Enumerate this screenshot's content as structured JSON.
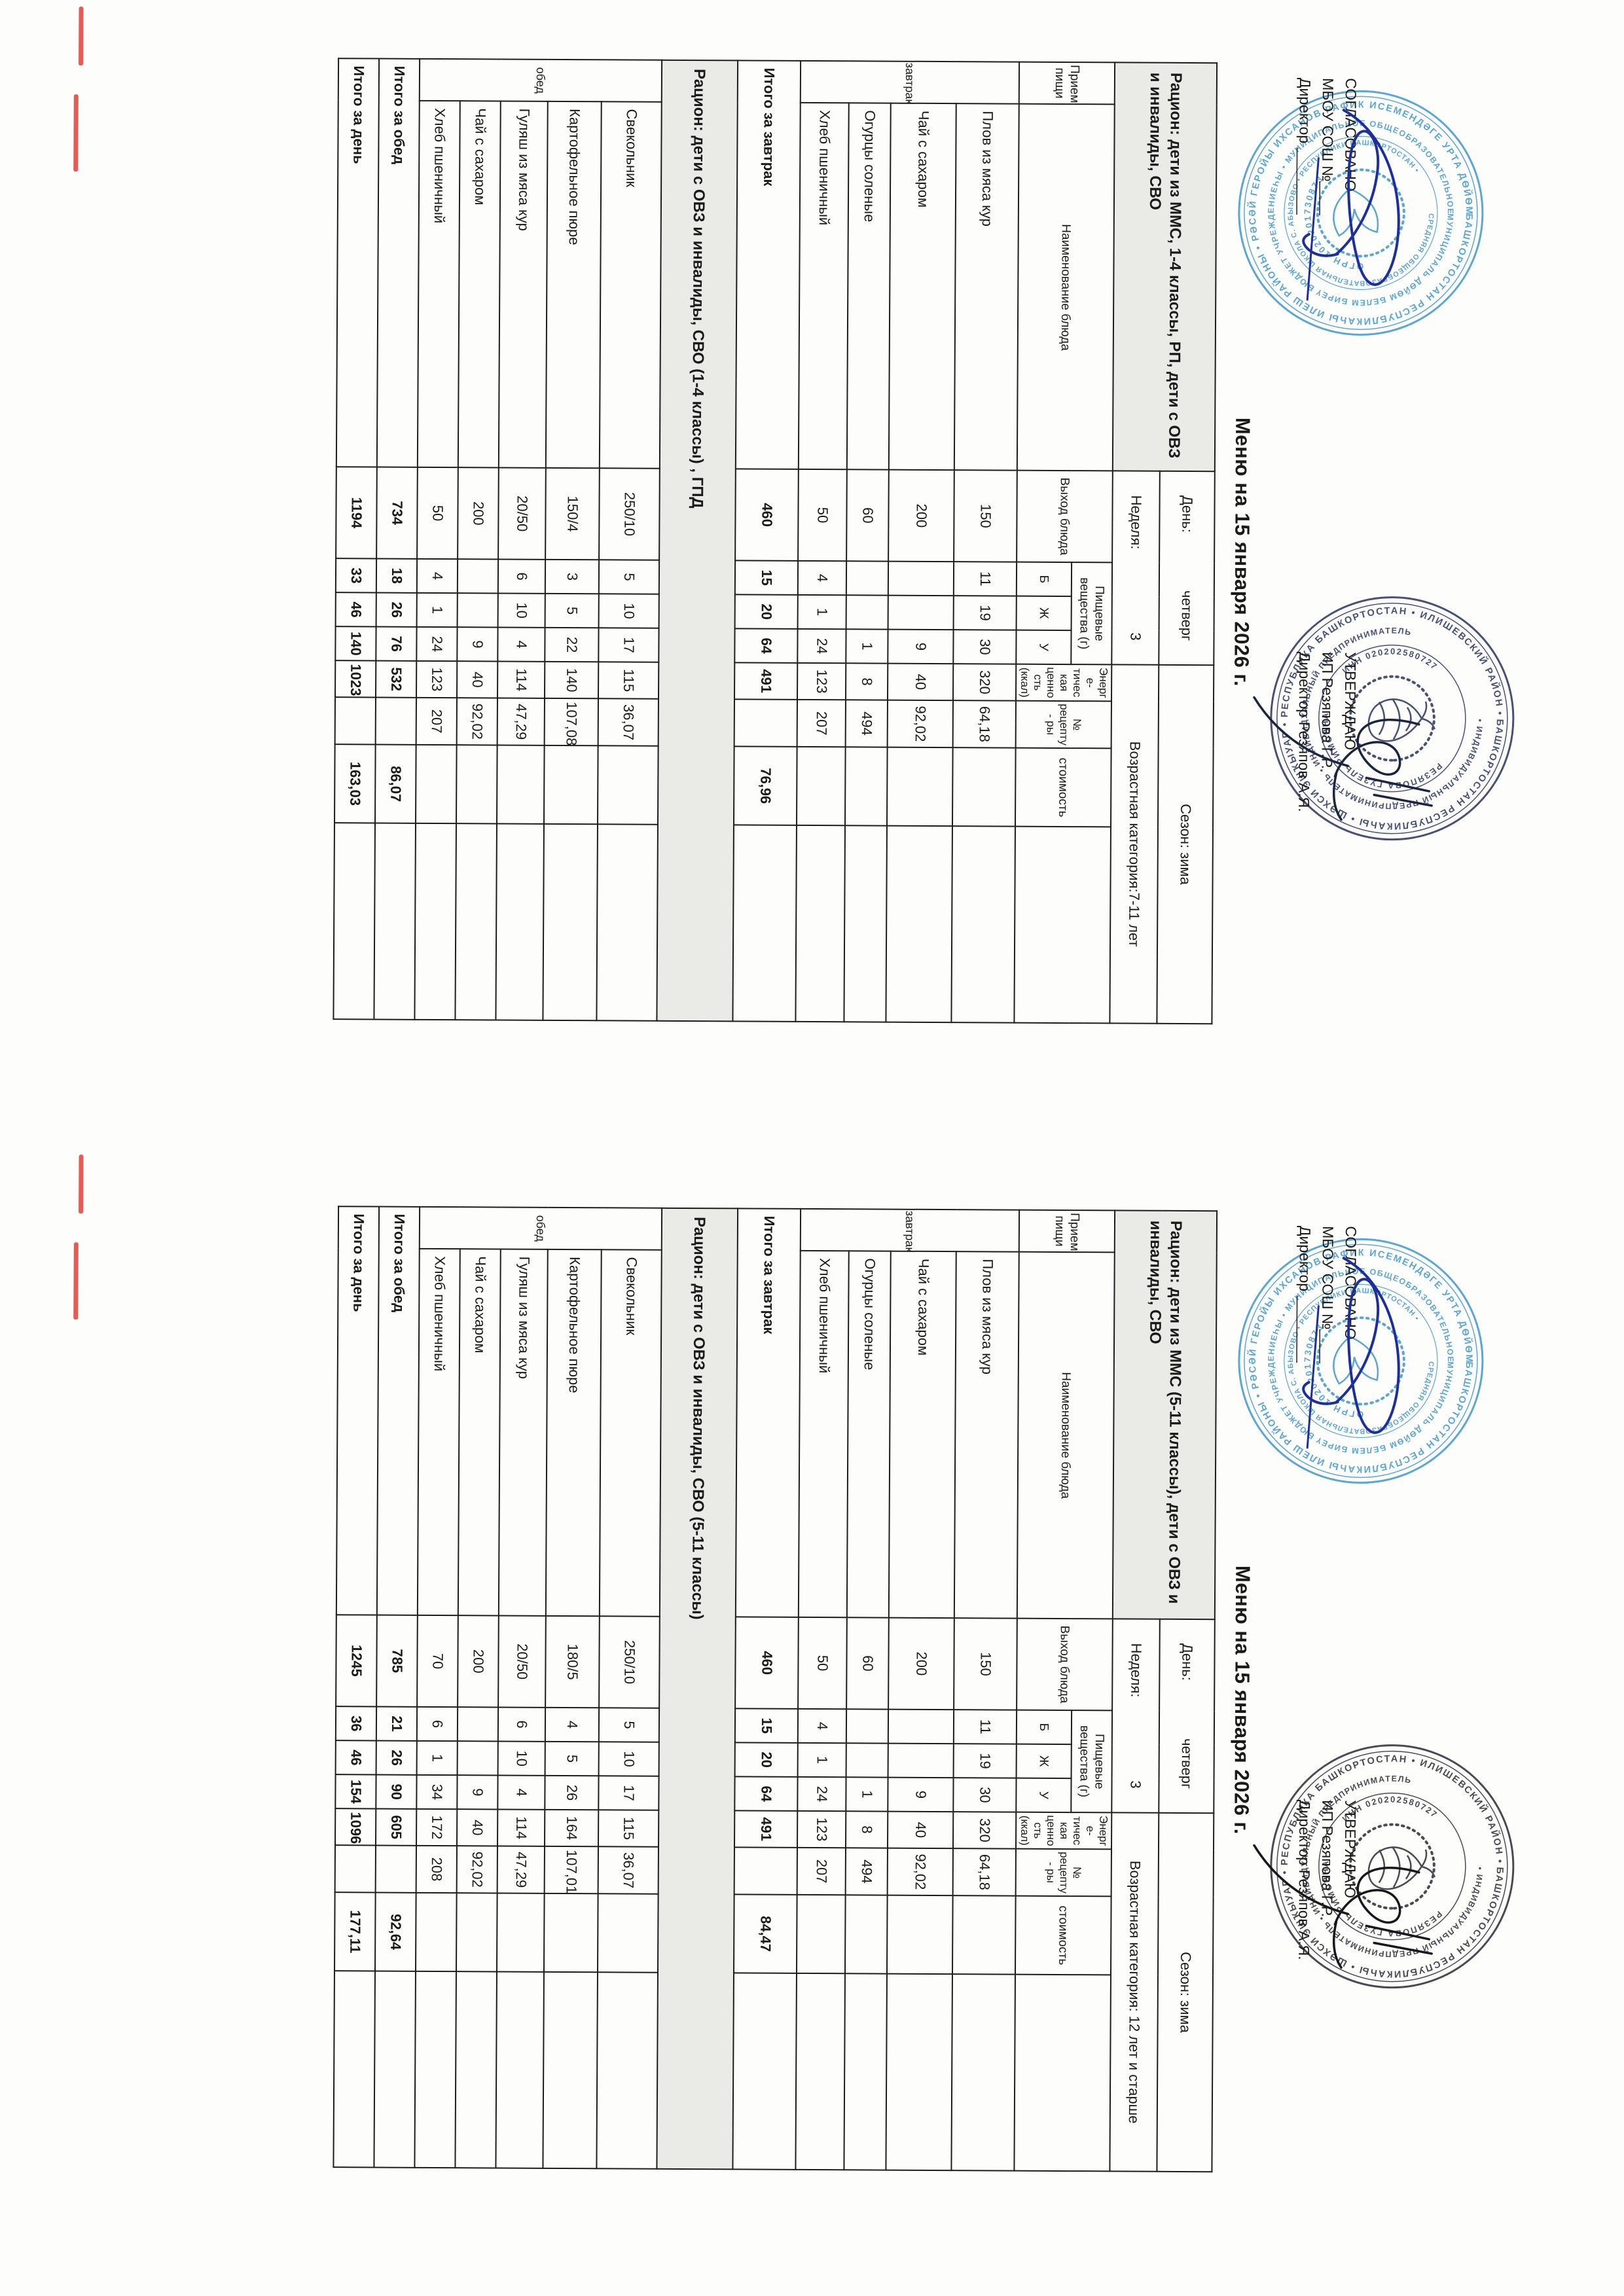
{
  "document": {
    "menu_title": "Меню на 15 января 2026 г.",
    "agreed_block": {
      "line1": "СОГЛАСОВАНО",
      "line2": "МБОУ СОШ №____",
      "line3": "Директор ________"
    },
    "approved_block": {
      "line1": "УТВЕРЖДАЮ",
      "line2": "ИП Резяпова Г.Р.",
      "line3": "Директор Резяпов А.Я."
    }
  },
  "stamps": {
    "school": {
      "color": "#4e9fd2",
      "ring_outer": "БАШКОРТОСТАН РЕСПУБЛИКАҺЫ ИЛЕШ РАЙОНЫ • РӘСӘЙ ГЕРОЙЫ ИХСАНОВ РАФИК ИСЕМЕНДӘГЕ УРТА ДѲЙѲМ БЕЛЕМ БИРЕҮ •",
      "ring_mid": "МУНИЦИПАЛЬ ДѲЙѲМ БЕЛЕМ БИРЕҮ БЮДЖЕТ УЧРЕЖДЕНИЕҺЫ • МУНИЦИПАЛЬНОЕ ОБЩЕОБРАЗОВАТЕЛЬНОЕ БЮДЖЕТНОЕ УЧРЕЖДЕНИЕ",
      "ring_inner": "СРЕДНЯЯ ОБЩЕОБРАЗОВАТЕЛЬНАЯ ШКОЛА С. АБЫЗОВО • РЕСПУБЛИКИ БАШКОРТОСТАН •",
      "ogrn": "ОГРН 1020201730873"
    },
    "ip": {
      "color": "#39426b",
      "color_second": "#3b3b44",
      "ring_outer": "БАШКОРТОСТАН РЕСПУБЛИКАҺЫ • ШӘХСИ ЭШҠЫУАР • РЕСПУБЛИКА БАШКОРТОСТАН • ИЛИШЕВСКИЙ РАЙОН •",
      "ring_mid": "• ИНДИВИДУАЛЬНЫЙ ПРЕДПРИНИМАТЕЛЬ • ИНДИВИДУАЛЬНЫЙ ПРЕДПРИНИМАТЕЛЬ",
      "name": "РЕЗЯПОВА ГУЗЕЛЬ РИМОВНА",
      "inn": "ИНН 020202580727"
    }
  },
  "columns": {
    "meal": "Прием пищи",
    "dish": "Наименование блюда",
    "out": "Выход блюда",
    "nutrients": "Пищевые вещества (г)",
    "b": "Б",
    "zh": "Ж",
    "u": "У",
    "kcal": "Энерге- тическая ценность (ккал)",
    "rec": "№ рецепту- ры",
    "cost": "стоимость"
  },
  "tables": [
    {
      "ration": "Рацион: дети из ММС, 1-4 классы, РП, дети с ОВЗ и инвалиды, СВО",
      "day_label": "День:",
      "day": "четверг",
      "week_label": "Неделя:",
      "week": "3",
      "season": "Сезон: зима",
      "age": "Возрастная категория:7-11 лет",
      "breakfast_label": "завтрак",
      "breakfast": [
        {
          "name": "Плов из мяса кур",
          "out": "150",
          "b": "11",
          "zh": "19",
          "u": "30",
          "kcal": "320",
          "rec": "64,18",
          "cost": ""
        },
        {
          "name": "Чай с сахаром",
          "out": "200",
          "b": "",
          "zh": "",
          "u": "9",
          "kcal": "40",
          "rec": "92,02",
          "cost": ""
        },
        {
          "name": "Огурцы соленые",
          "out": "60",
          "b": "",
          "zh": "",
          "u": "1",
          "kcal": "8",
          "rec": "494",
          "cost": ""
        },
        {
          "name": "Хлеб пшеничный",
          "out": "50",
          "b": "4",
          "zh": "1",
          "u": "24",
          "kcal": "123",
          "rec": "207",
          "cost": ""
        }
      ],
      "breakfast_total": {
        "label": "Итого за завтрак",
        "out": "460",
        "b": "15",
        "zh": "20",
        "u": "64",
        "kcal": "491",
        "rec": "",
        "cost": "76,96"
      },
      "subheader": "Рацион: дети с ОВЗ и инвалиды, СВО (1-4 классы) , ГПД",
      "lunch_label": "обед",
      "lunch": [
        {
          "name": "Свекольник",
          "out": "250/10",
          "b": "5",
          "zh": "10",
          "u": "17",
          "kcal": "115",
          "rec": "36,07",
          "cost": ""
        },
        {
          "name": "Картофельное пюре",
          "out": "150/4",
          "b": "3",
          "zh": "5",
          "u": "22",
          "kcal": "140",
          "rec": "107,08",
          "cost": ""
        },
        {
          "name": "Гуляш из мяса кур",
          "out": "20/50",
          "b": "6",
          "zh": "10",
          "u": "4",
          "kcal": "114",
          "rec": "47,29",
          "cost": ""
        },
        {
          "name": "Чай с сахаром",
          "out": "200",
          "b": "",
          "zh": "",
          "u": "9",
          "kcal": "40",
          "rec": "92,02",
          "cost": ""
        },
        {
          "name": "Хлеб пшеничный",
          "out": "50",
          "b": "4",
          "zh": "1",
          "u": "24",
          "kcal": "123",
          "rec": "207",
          "cost": ""
        }
      ],
      "lunch_total": {
        "label": "Итого за обед",
        "out": "734",
        "b": "18",
        "zh": "26",
        "u": "76",
        "kcal": "532",
        "rec": "",
        "cost": "86,07"
      },
      "day_total": {
        "label": "Итого за день",
        "out": "1194",
        "b": "33",
        "zh": "46",
        "u": "140",
        "kcal": "1023",
        "rec": "",
        "cost": "163,03"
      }
    },
    {
      "ration": "Рацион: дети из ММС (5-11  классы), дети с ОВЗ и инвалиды, СВО",
      "day_label": "День:",
      "day": "четверг",
      "week_label": "Неделя:",
      "week": "3",
      "season": "Сезон: зима",
      "age": "Возрастная категория: 12 лет и старше",
      "breakfast_label": "завтрак",
      "breakfast": [
        {
          "name": "Плов из мяса кур",
          "out": "150",
          "b": "11",
          "zh": "19",
          "u": "30",
          "kcal": "320",
          "rec": "64,18",
          "cost": ""
        },
        {
          "name": "Чай с сахаром",
          "out": "200",
          "b": "",
          "zh": "",
          "u": "9",
          "kcal": "40",
          "rec": "92,02",
          "cost": ""
        },
        {
          "name": "Огурцы соленые",
          "out": "60",
          "b": "",
          "zh": "",
          "u": "1",
          "kcal": "8",
          "rec": "494",
          "cost": ""
        },
        {
          "name": "Хлеб пшеничный",
          "out": "50",
          "b": "4",
          "zh": "1",
          "u": "24",
          "kcal": "123",
          "rec": "207",
          "cost": ""
        }
      ],
      "breakfast_total": {
        "label": "Итого за завтрак",
        "out": "460",
        "b": "15",
        "zh": "20",
        "u": "64",
        "kcal": "491",
        "rec": "",
        "cost": "84,47"
      },
      "subheader": "Рацион: дети с ОВЗ и инвалиды, СВО (5-11 классы)",
      "lunch_label": "обед",
      "lunch": [
        {
          "name": "Свекольник",
          "out": "250/10",
          "b": "5",
          "zh": "10",
          "u": "17",
          "kcal": "115",
          "rec": "36,07",
          "cost": ""
        },
        {
          "name": "Картофельное пюре",
          "out": "180/5",
          "b": "4",
          "zh": "5",
          "u": "26",
          "kcal": "164",
          "rec": "107,01",
          "cost": ""
        },
        {
          "name": "Гуляш из мяса кур",
          "out": "20/50",
          "b": "6",
          "zh": "10",
          "u": "4",
          "kcal": "114",
          "rec": "47,29",
          "cost": ""
        },
        {
          "name": "Чай с сахаром",
          "out": "200",
          "b": "",
          "zh": "",
          "u": "9",
          "kcal": "40",
          "rec": "92,02",
          "cost": ""
        },
        {
          "name": "Хлеб пшеничный",
          "out": "70",
          "b": "6",
          "zh": "1",
          "u": "34",
          "kcal": "172",
          "rec": "208",
          "cost": ""
        }
      ],
      "lunch_total": {
        "label": "Итого за обед",
        "out": "785",
        "b": "21",
        "zh": "26",
        "u": "90",
        "kcal": "605",
        "rec": "",
        "cost": "92,64"
      },
      "day_total": {
        "label": "Итого за день",
        "out": "1245",
        "b": "36",
        "zh": "46",
        "u": "154",
        "kcal": "1096",
        "rec": "",
        "cost": "177,11"
      }
    }
  ]
}
